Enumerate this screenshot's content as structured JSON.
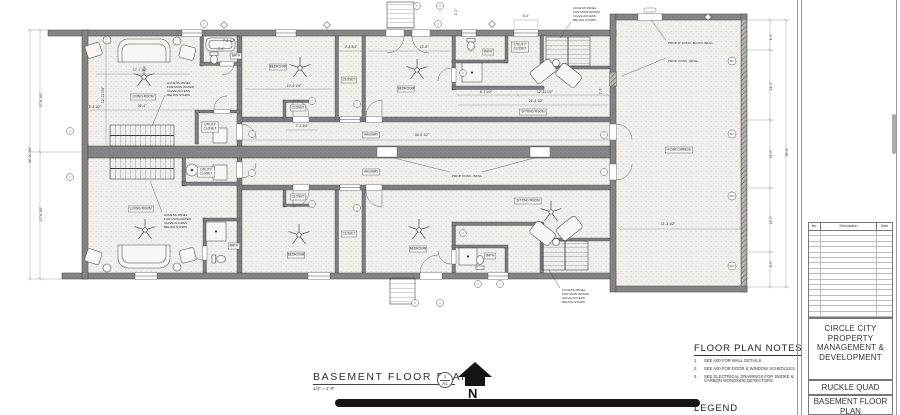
{
  "drawing": {
    "plan_title": {
      "label": "BASEMENT FLOOR PLAN",
      "scale": "1/4\" = 1'-0\"",
      "detail_number": "1",
      "sheet_ref": "A1",
      "north_label": "N"
    },
    "notes_panel": {
      "title": "FLOOR PLAN NOTES",
      "items": [
        {
          "num": "1.",
          "text": "SEE A00 FOR WALL DETAILS."
        },
        {
          "num": "2.",
          "text": "SEE A00 FOR DOOR & WINDOW SCHEDULES."
        },
        {
          "num": "3.",
          "text": "SEE ELECTRICAL DRAWINGS FOR SMOKE & CARBON MONOXIDE DETECTORS."
        }
      ]
    },
    "legend": {
      "title": "LEGEND"
    },
    "title_block": {
      "revision_table": {
        "headers": [
          "No.",
          "Description",
          "Date"
        ],
        "empty_rows": 16
      },
      "company_lines": [
        "CIRCLE CITY",
        "PROPERTY",
        "MANAGEMENT &",
        "DEVELOPMENT"
      ],
      "project_name": "RUCKLE QUAD",
      "sheet_name_lines": [
        "BASEMENT FLOOR",
        "PLAN"
      ]
    },
    "plan": {
      "rooms": [
        {
          "label": "LIVING ROOM",
          "x": 143,
          "y": 97
        },
        {
          "label": "LIVING ROOM",
          "x": 141,
          "y": 209
        },
        {
          "label": "BEDROOM",
          "x": 278,
          "y": 67
        },
        {
          "label": "BEDROOM",
          "x": 406,
          "y": 89
        },
        {
          "label": "BEDROOM",
          "x": 296,
          "y": 255
        },
        {
          "label": "BEDROOM",
          "x": 418,
          "y": 249
        },
        {
          "label": "CLOSET",
          "x": 349,
          "y": 80
        },
        {
          "label": "CLOSET",
          "x": 298,
          "y": 108
        },
        {
          "label": "CLOSET",
          "x": 298,
          "y": 197
        },
        {
          "label": "CLOSET",
          "x": 349,
          "y": 234
        },
        {
          "label": "HALLWAY",
          "x": 371,
          "y": 135
        },
        {
          "label": "HALLWAY",
          "x": 371,
          "y": 172
        },
        {
          "label": "SITTING ROOM",
          "x": 533,
          "y": 112
        },
        {
          "label": "SITTING ROOM",
          "x": 528,
          "y": 201
        },
        {
          "label": "BATH",
          "x": 236,
          "y": 56
        },
        {
          "label": "BATH",
          "x": 488,
          "y": 52
        },
        {
          "label": "BATH",
          "x": 234,
          "y": 246
        },
        {
          "label": "BATH",
          "x": 490,
          "y": 256
        },
        {
          "label": "UTILITY\nCLOSET",
          "x": 210,
          "y": 127
        },
        {
          "label": "UTILITY\nCLOSET",
          "x": 520,
          "y": 47
        },
        {
          "label": "UTILITY\nCLOSET",
          "x": 206,
          "y": 172
        },
        {
          "label": "4-CAR GARAGE",
          "x": 679,
          "y": 150
        }
      ],
      "dimensions": [
        {
          "t": "17'-6 1/2\"",
          "x": 42,
          "y": 100,
          "r": -90
        },
        {
          "t": "34'-10 1/2\"",
          "x": 31,
          "y": 155,
          "r": -90
        },
        {
          "t": "17'-6 1/2\"",
          "x": 42,
          "y": 214,
          "r": -90
        },
        {
          "t": "17'-7 1/2\"",
          "x": 140,
          "y": 71
        },
        {
          "t": "12'-11 1/4\"",
          "x": 104,
          "y": 95,
          "r": -90
        },
        {
          "t": "16'-4\"",
          "x": 142,
          "y": 107
        },
        {
          "t": "5'-3 1/2\"",
          "x": 95,
          "y": 108
        },
        {
          "t": "7'-8 1/2\"",
          "x": 229,
          "y": 42
        },
        {
          "t": "7'-4\"",
          "x": 221,
          "y": 50
        },
        {
          "t": "10'-4 1/4\"",
          "x": 294,
          "y": 87
        },
        {
          "t": "4'-8 3/4\"",
          "x": 351,
          "y": 48
        },
        {
          "t": "13'-0\"",
          "x": 424,
          "y": 48
        },
        {
          "t": "7'-1 3/4\"",
          "x": 302,
          "y": 127
        },
        {
          "t": "34'-9 1/2\"",
          "x": 422,
          "y": 136
        },
        {
          "t": "2'-0\"",
          "x": 457,
          "y": 12,
          "r": -90
        },
        {
          "t": "5'-0\"",
          "x": 526,
          "y": 17
        },
        {
          "t": "6'-7 1/2\"",
          "x": 486,
          "y": 93
        },
        {
          "t": "12'-11 1/2\"",
          "x": 545,
          "y": 93
        },
        {
          "t": "21'-4 1/2\"",
          "x": 536,
          "y": 102
        },
        {
          "t": "7'-7\"",
          "x": 602,
          "y": 91,
          "r": -90
        },
        {
          "t": "4'-0\"",
          "x": 772,
          "y": 37,
          "r": -90
        },
        {
          "t": "13'-0\"",
          "x": 772,
          "y": 86,
          "r": -90
        },
        {
          "t": "13'-0\"",
          "x": 772,
          "y": 154,
          "r": -90
        },
        {
          "t": "13'-0\"",
          "x": 772,
          "y": 220,
          "r": -90
        },
        {
          "t": "4'-0\"",
          "x": 772,
          "y": 264,
          "r": -90
        },
        {
          "t": "39'-6\"",
          "x": 788,
          "y": 152,
          "r": -90
        },
        {
          "t": "11'-3 1/2\"",
          "x": 668,
          "y": 225
        }
      ],
      "annotations": [
        {
          "lines": [
            "ACCESS PANEL",
            "FOR MAIN WATER",
            "VALVE ACCESS",
            "BELOW STAIRS"
          ],
          "x": 167,
          "y": 81,
          "leader": [
            165,
            95,
            152,
            126
          ]
        },
        {
          "lines": [
            "ACCESS PANEL",
            "FOR MAIN WATER",
            "VALVE ACCESS",
            "BELOW STAIRS"
          ],
          "x": 573,
          "y": 6,
          "leader": [
            571,
            22,
            560,
            38
          ]
        },
        {
          "lines": [
            "ACCESS PANEL",
            "FOR MAIN WATER",
            "VALVE ACCESS",
            "BELOW STAIRS"
          ],
          "x": 164,
          "y": 213,
          "leader": [
            162,
            212,
            150,
            181
          ]
        },
        {
          "lines": [
            "ACCESS PANEL",
            "FOR MAIN WATER",
            "VALVE ACCESS",
            "BELOW STAIRS"
          ],
          "x": 562,
          "y": 288,
          "leader": [
            560,
            288,
            549,
            270
          ]
        },
        {
          "lines": [
            "PROP. 8\" CONC. BLOCK INFILL"
          ],
          "x": 668,
          "y": 41,
          "leader": [
            666,
            40,
            651,
            20
          ]
        },
        {
          "lines": [
            "PROP. CONC. INFILL"
          ],
          "x": 668,
          "y": 59,
          "leader": [
            666,
            58,
            622,
            76
          ]
        },
        {
          "lines": [
            "PROP. CONC. INFILL"
          ],
          "x": 452,
          "y": 174,
          "leader": [
            450,
            172,
            390,
            157
          ],
          "leader2": [
            482,
            172,
            538,
            157
          ]
        }
      ],
      "markers": {
        "circles": [
          {
            "x": 204,
            "y": 24
          },
          {
            "x": 417,
            "y": 6
          },
          {
            "x": 440,
            "y": 6
          },
          {
            "x": 438,
            "y": 24
          },
          {
            "x": 70,
            "y": 131
          },
          {
            "x": 70,
            "y": 177
          },
          {
            "x": 252,
            "y": 134
          },
          {
            "x": 252,
            "y": 173
          },
          {
            "x": 312,
            "y": 101
          },
          {
            "x": 357,
            "y": 104
          },
          {
            "x": 312,
            "y": 204
          },
          {
            "x": 357,
            "y": 208
          },
          {
            "x": 463,
            "y": 73
          },
          {
            "x": 463,
            "y": 233
          },
          {
            "x": 604,
            "y": 135
          },
          {
            "x": 604,
            "y": 172
          },
          {
            "x": 415,
            "y": 303
          },
          {
            "x": 440,
            "y": 303
          },
          {
            "x": 478,
            "y": 284
          },
          {
            "x": 500,
            "y": 284
          }
        ],
        "diamonds": [
          {
            "x": 224,
            "y": 25
          },
          {
            "x": 327,
            "y": 25
          },
          {
            "x": 492,
            "y": 24
          },
          {
            "x": 708,
            "y": 17
          }
        ],
        "garage_tags": [
          {
            "x": 732,
            "y": 61,
            "t": "B1"
          },
          {
            "x": 732,
            "y": 134,
            "t": "B2"
          },
          {
            "x": 732,
            "y": 196,
            "t": "B3"
          },
          {
            "x": 732,
            "y": 266,
            "t": "B4"
          }
        ]
      }
    }
  }
}
